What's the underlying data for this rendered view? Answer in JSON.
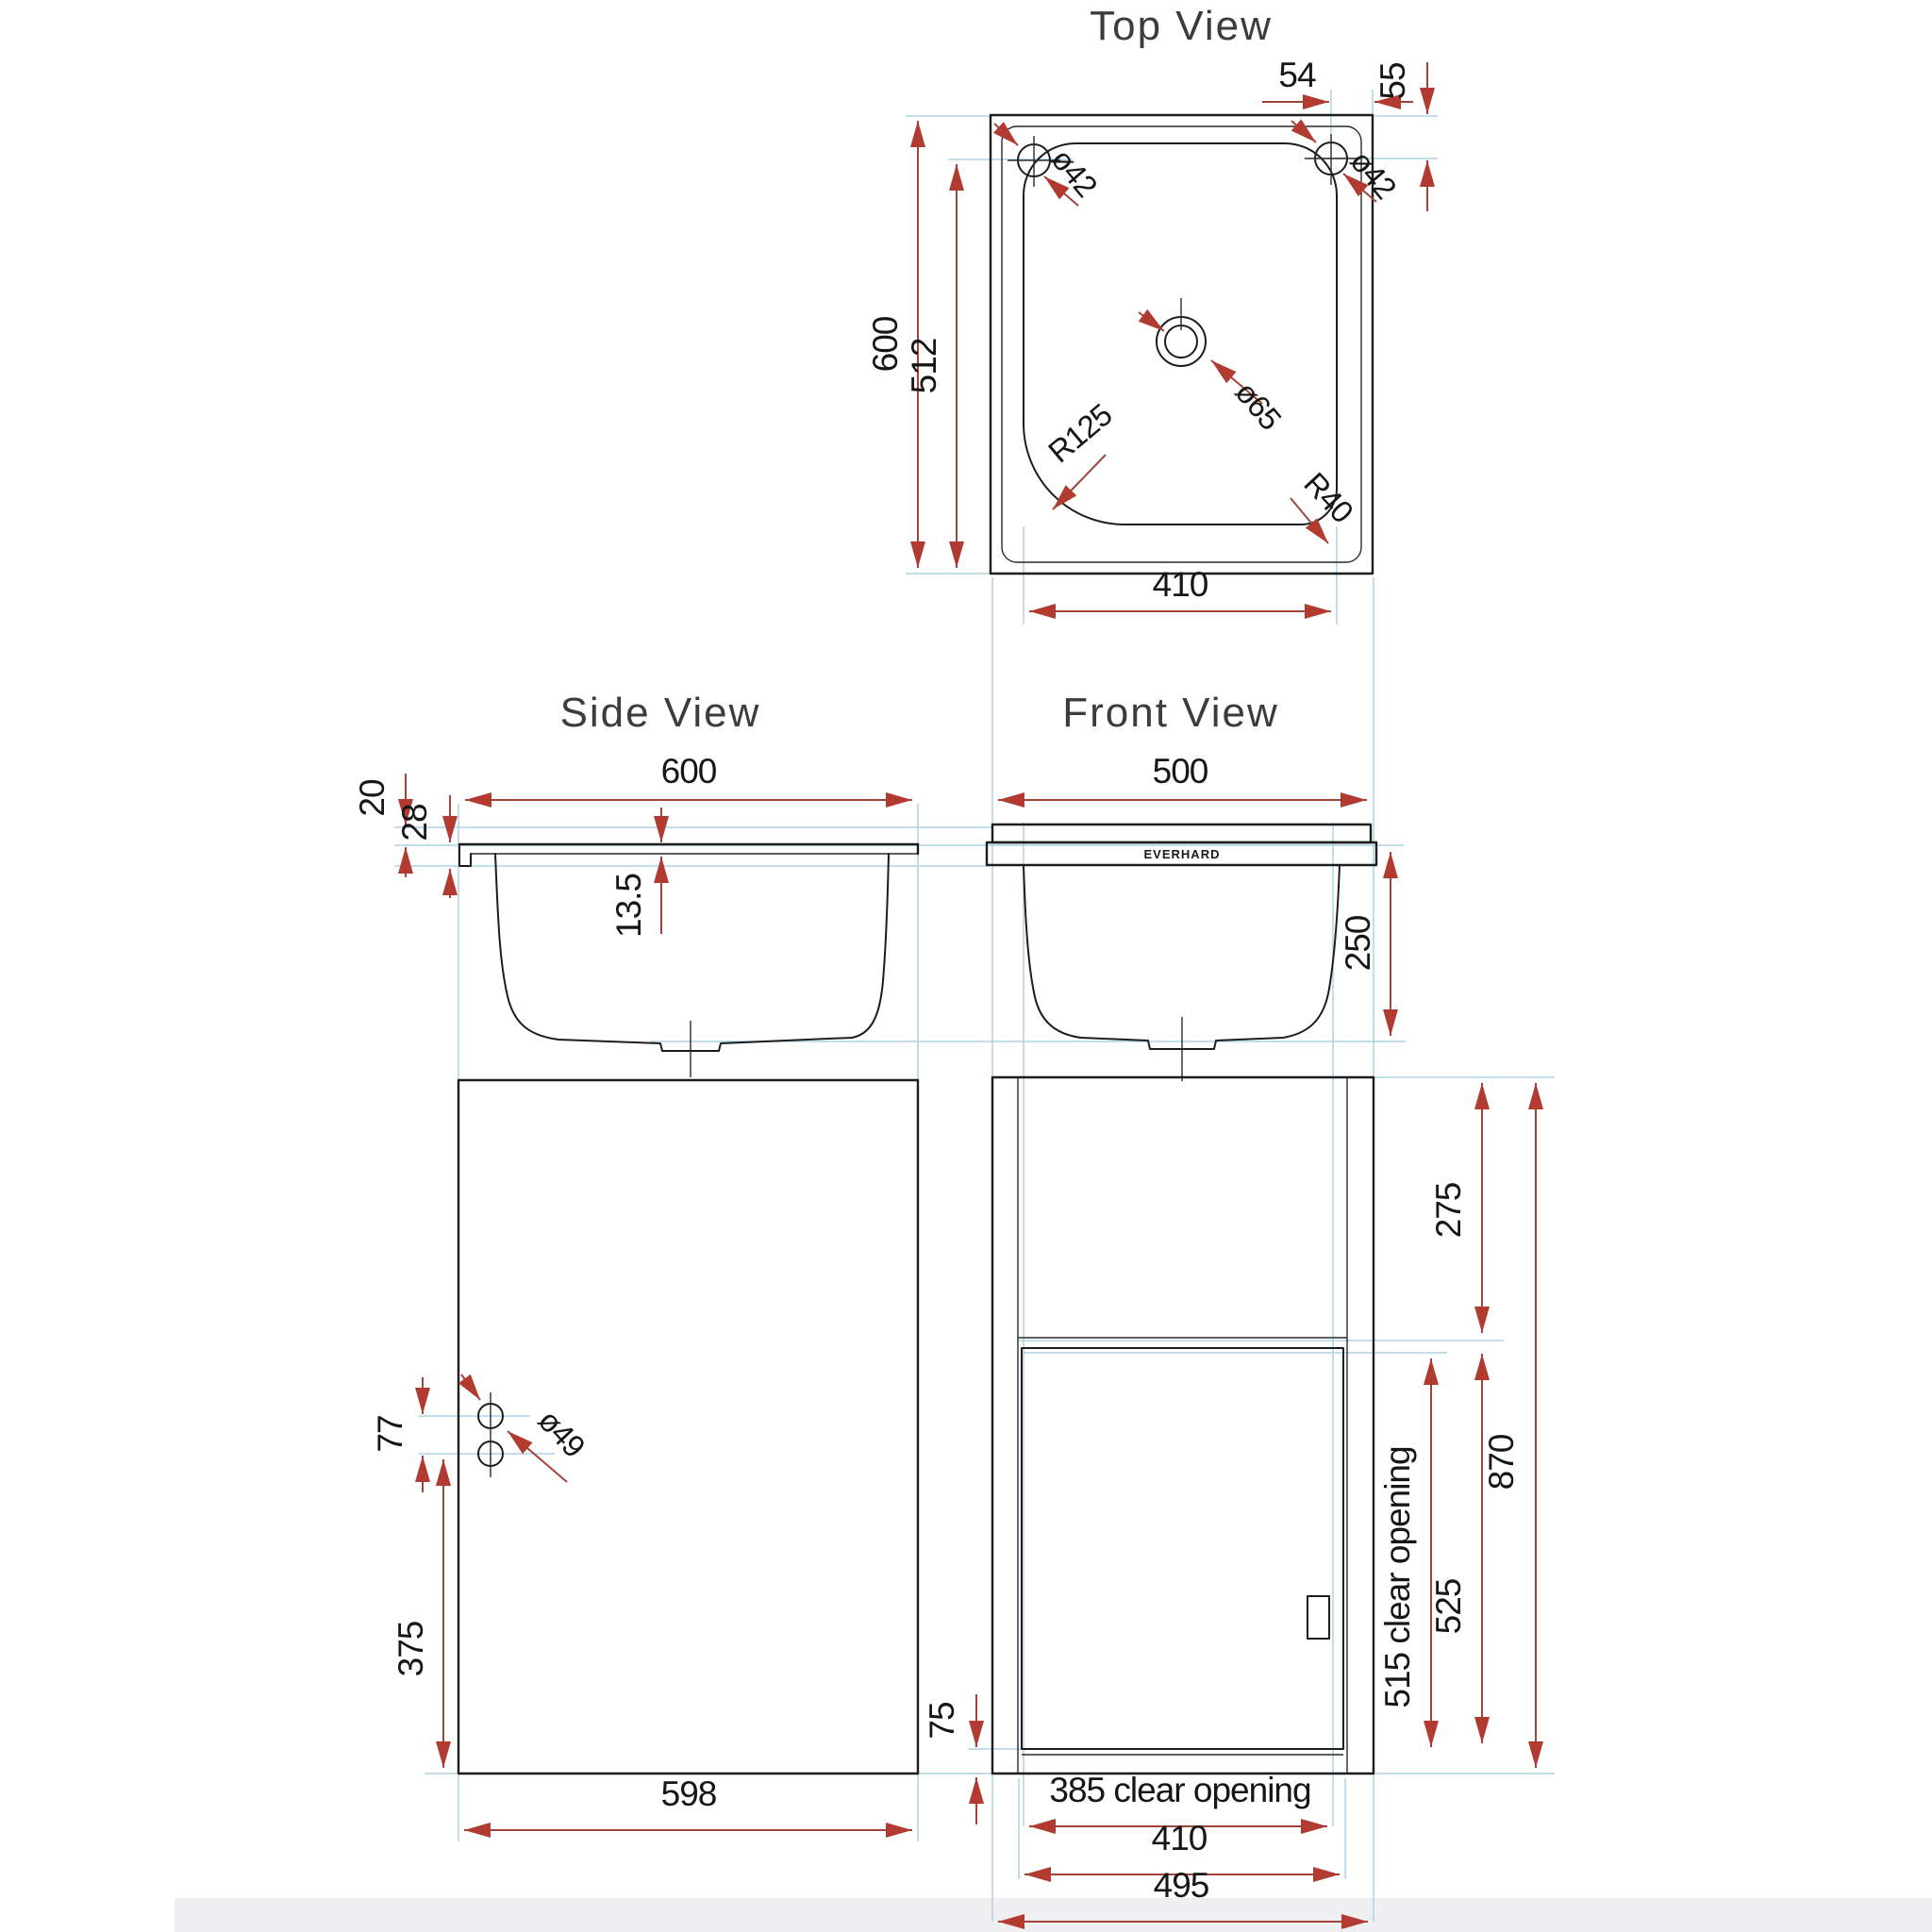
{
  "titles": {
    "top": "Top View",
    "side": "Side View",
    "front": "Front View"
  },
  "brand": "EVERHARD",
  "colors": {
    "dimension": "#b13a31",
    "extension": "#aed3e4",
    "line": "#1d1d1d",
    "floor": "#efeef0"
  },
  "top_view": {
    "overall_height": "600",
    "bowl_length": "512",
    "bowl_width": "410",
    "hole_left": "ø42",
    "hole_right": "ø42",
    "hole_offset_x": "54",
    "hole_offset_y": "55",
    "drain_diameter": "ø65",
    "bowl_corner_radius": "R125",
    "small_corner_radius": "R40"
  },
  "side_view": {
    "overall_width": "600",
    "rim_height": "20",
    "edge_height": "28",
    "top_thickness": "13.5"
  },
  "front_view": {
    "overall_width": "500",
    "bowl_depth": "250"
  },
  "cabinet_side": {
    "hole_gap": "77",
    "hole_diameter": "ø49",
    "holes_from_bottom": "375",
    "depth": "598"
  },
  "cabinet_front": {
    "top_section": "275",
    "overall_height": "870",
    "door_height": "525",
    "clear_opening_height": "515 clear opening",
    "plinth": "75",
    "clear_opening_width": "385 clear opening",
    "door_width": "410",
    "overall_width": "495"
  }
}
